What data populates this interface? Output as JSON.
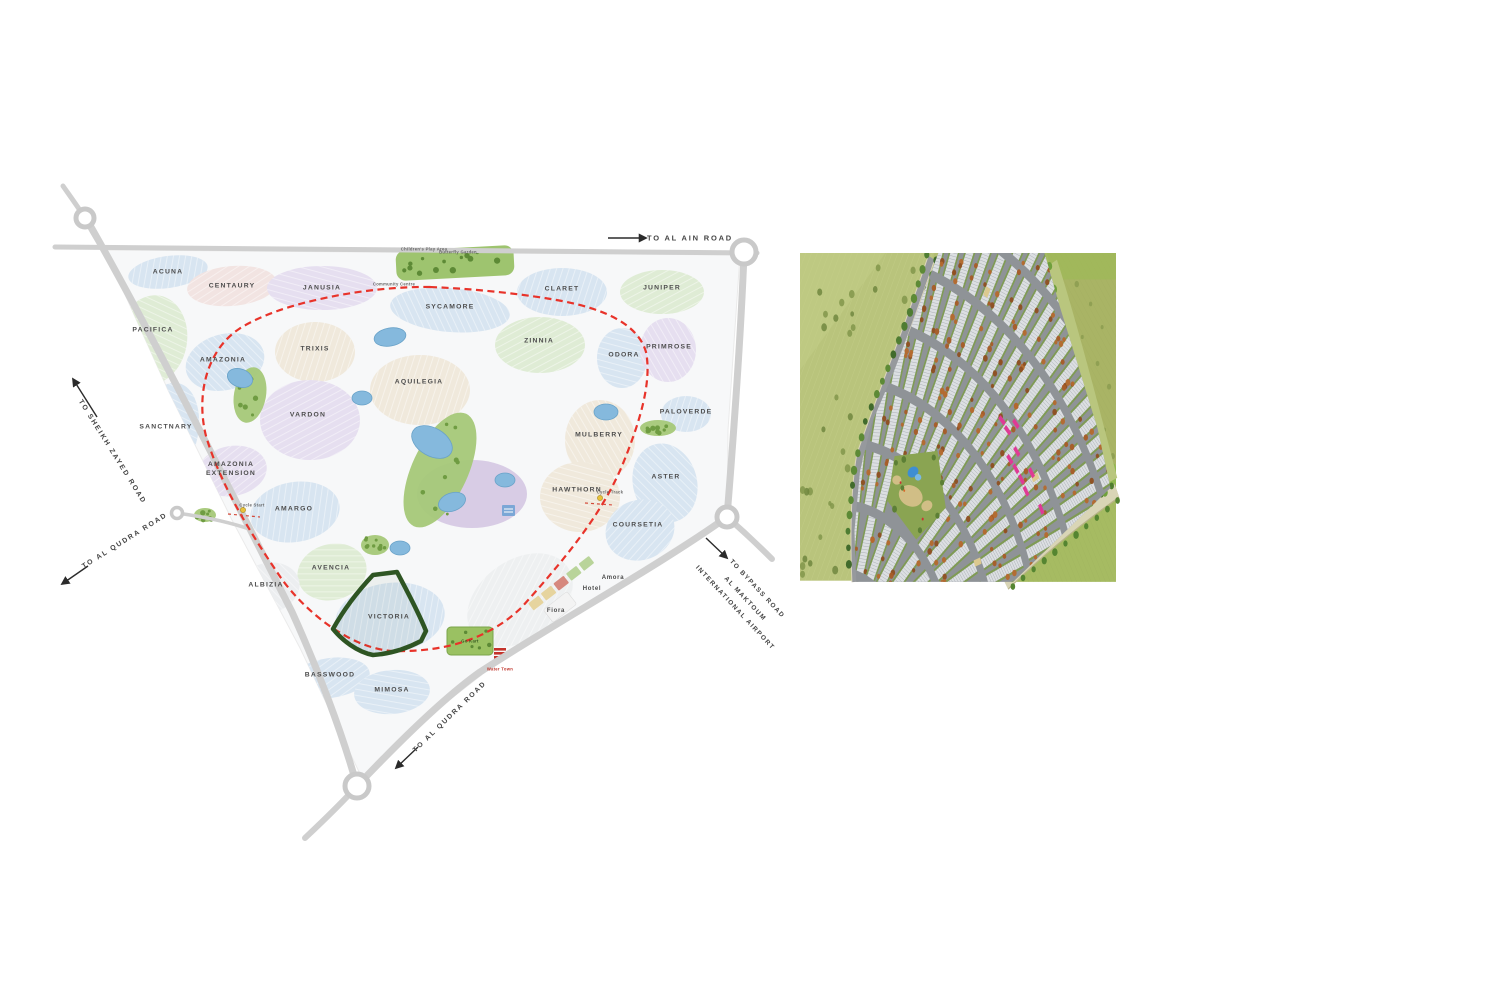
{
  "palette": {
    "cluster_blue": "#d8e5f1",
    "cluster_green": "#dfecd5",
    "cluster_lavender": "#e6dff0",
    "cluster_cream": "#f0e9dc",
    "cluster_pink": "#f2e4e2",
    "cluster_gray": "#eceef0",
    "road": "#cfcfcf",
    "boundary_red": "#e8332a",
    "highlight_green": "#2e5523",
    "lake": "#85b9dd",
    "park": "#a5c878"
  },
  "left_map": {
    "highlighted_cluster": "VICTORIA",
    "clusters": [
      {
        "name": "ACUNA",
        "x": 168,
        "y": 272,
        "w": 80,
        "h": 32,
        "rot": -8,
        "color": "blue"
      },
      {
        "name": "CENTAURY",
        "x": 232,
        "y": 286,
        "w": 90,
        "h": 40,
        "rot": -5,
        "color": "pink"
      },
      {
        "name": "JANUSIA",
        "x": 322,
        "y": 288,
        "w": 110,
        "h": 44,
        "rot": 0,
        "color": "lavender"
      },
      {
        "name": "SYCAMORE",
        "x": 450,
        "y": 310,
        "w": 120,
        "h": 44,
        "rot": 5,
        "color": "blue"
      },
      {
        "name": "CLARET",
        "x": 562,
        "y": 292,
        "w": 90,
        "h": 48,
        "rot": 0,
        "color": "blue"
      },
      {
        "name": "JUNIPER",
        "x": 662,
        "y": 292,
        "w": 84,
        "h": 44,
        "rot": 0,
        "color": "green"
      },
      {
        "name": "PACIFICA",
        "x": 152,
        "y": 340,
        "w": 70,
        "h": 90,
        "rot": 10,
        "color": "green"
      },
      {
        "name": "AMAZONIA",
        "x": 225,
        "y": 362,
        "w": 80,
        "h": 56,
        "rot": -15,
        "color": "blue"
      },
      {
        "name": "TRIXIS",
        "x": 315,
        "y": 352,
        "w": 80,
        "h": 60,
        "rot": 0,
        "color": "cream"
      },
      {
        "name": "ZINNIA",
        "x": 540,
        "y": 345,
        "w": 90,
        "h": 56,
        "rot": 0,
        "color": "green"
      },
      {
        "name": "ODORA",
        "x": 622,
        "y": 358,
        "w": 50,
        "h": 60,
        "rot": 0,
        "color": "blue"
      },
      {
        "name": "PRIMROSE",
        "x": 668,
        "y": 350,
        "w": 56,
        "h": 64,
        "rot": 0,
        "color": "lavender"
      },
      {
        "name": "AQUILEGIA",
        "x": 420,
        "y": 390,
        "w": 100,
        "h": 70,
        "rot": 0,
        "color": "cream"
      },
      {
        "name": "VARDON",
        "x": 310,
        "y": 420,
        "w": 100,
        "h": 80,
        "rot": 0,
        "color": "lavender"
      },
      {
        "name": "SANCTNARY",
        "x": 168,
        "y": 432,
        "w": 60,
        "h": 100,
        "rot": 12,
        "color": "blue"
      },
      {
        "name": "MULBERRY",
        "x": 600,
        "y": 440,
        "w": 70,
        "h": 80,
        "rot": 0,
        "color": "cream"
      },
      {
        "name": "PALOVERDE",
        "x": 686,
        "y": 414,
        "w": 50,
        "h": 36,
        "rot": 0,
        "color": "blue"
      },
      {
        "name": "AMAZONIA EXTENSION",
        "x": 232,
        "y": 471,
        "w": 70,
        "h": 50,
        "rot": -10,
        "color": "lavender"
      },
      {
        "name": "HAWTHORN",
        "x": 580,
        "y": 497,
        "w": 80,
        "h": 70,
        "rot": 0,
        "color": "cream"
      },
      {
        "name": "ASTER",
        "x": 665,
        "y": 483,
        "w": 64,
        "h": 80,
        "rot": -15,
        "color": "blue"
      },
      {
        "name": "AMARGO",
        "x": 295,
        "y": 512,
        "w": 90,
        "h": 60,
        "rot": -10,
        "color": "blue"
      },
      {
        "name": "COURSETIA",
        "x": 640,
        "y": 530,
        "w": 70,
        "h": 60,
        "rot": -20,
        "color": "blue"
      },
      {
        "name": "AVENCIA",
        "x": 332,
        "y": 572,
        "w": 70,
        "h": 56,
        "rot": -15,
        "color": "green"
      },
      {
        "name": "ALBIZIA",
        "x": 268,
        "y": 588,
        "w": 64,
        "h": 50,
        "rot": -15,
        "color": "gray"
      },
      {
        "name": "VICTORIA",
        "x": 390,
        "y": 618,
        "w": 110,
        "h": 70,
        "rot": -8,
        "color": "blue"
      },
      {
        "name": "BASSWOOD",
        "x": 330,
        "y": 678,
        "w": 80,
        "h": 40,
        "rot": -8,
        "color": "blue"
      },
      {
        "name": "MIMOSA",
        "x": 392,
        "y": 692,
        "w": 76,
        "h": 44,
        "rot": -5,
        "color": "blue"
      }
    ],
    "road_labels": {
      "al_ain": "TO AL AIN ROAD",
      "szr": "TO SHEIKH ZAYED ROAD",
      "qudra_left": "TO AL QUDRA ROAD",
      "qudra_bottom": "TO AL QUDRA ROAD",
      "bypass_1": "TO BYPASS ROAD",
      "bypass_2": "AL MAKTOUM",
      "bypass_3": "INTERNATIONAL AIRPORT"
    },
    "poi_labels": {
      "amora": "Amora",
      "hotel": "Hotel",
      "fiora": "Fiora",
      "water_town": "Water Town",
      "go_kart": "Go Kart",
      "cycle_track": "Cycle Track",
      "cycle_start": "Cycle Start",
      "community_centre": "Community Centre",
      "childrens_play_area": "Children's Play Area",
      "butterfly_garden": "Butterfly Garden"
    }
  },
  "right_map": {
    "colors": {
      "field": "#b2bd72",
      "field_light": "#b9c47c",
      "road": "#96999d",
      "fan": "#8f9397",
      "house": "#dcdfe2",
      "house_line": "#989ea3",
      "green_strip": "#7d9c4c",
      "tree_orange": "#a85c28",
      "tree_green": "#5d8a36",
      "band": "#b9c67e",
      "path": "#d9d5b6",
      "park": "#8aa452",
      "pool": "#3e8ed2"
    },
    "highlighted_units": {
      "color": "#df3a95",
      "positions": [
        [
          1238,
          506
        ],
        [
          1250,
          521
        ],
        [
          1268,
          511
        ],
        [
          1255,
          565
        ],
        [
          1268,
          579
        ],
        [
          1280,
          595
        ],
        [
          1302,
          585
        ],
        [
          1323,
          640
        ],
        [
          1270,
          553
        ],
        [
          1290,
          613
        ]
      ]
    }
  }
}
